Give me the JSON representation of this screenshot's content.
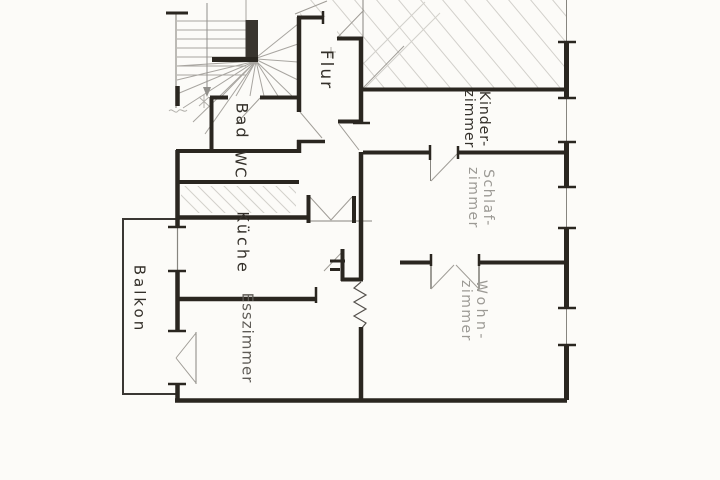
{
  "drawing": {
    "kind_note": "hand-drawn apartment floor plan (scan)",
    "palette": {
      "paper": "#fcfbf8",
      "ink": "#2a2620",
      "thin": "#87857f",
      "pencil": "#a8a5a0",
      "hatch": "#d2d0cb",
      "label_dark": "#34302a",
      "label_mid": "#5f5c57",
      "label_light": "#9c9a95",
      "balcony": "#3a3733"
    }
  },
  "rooms": {
    "flur": {
      "label": "Flur"
    },
    "bad": {
      "label": "Bad"
    },
    "wc": {
      "label": "WC"
    },
    "kueche": {
      "label": "Küche"
    },
    "esszimmer": {
      "label": "Esszimmer"
    },
    "balkon": {
      "label": "Balkon"
    },
    "kinderzimmer": {
      "line1": "Kinder-",
      "line2": "zimmer"
    },
    "schlafzimmer": {
      "line1": "Schlaf-",
      "line2": "zimmer"
    },
    "wohnzimmer": {
      "line1": "Wohn-",
      "line2": "zimmer"
    }
  }
}
